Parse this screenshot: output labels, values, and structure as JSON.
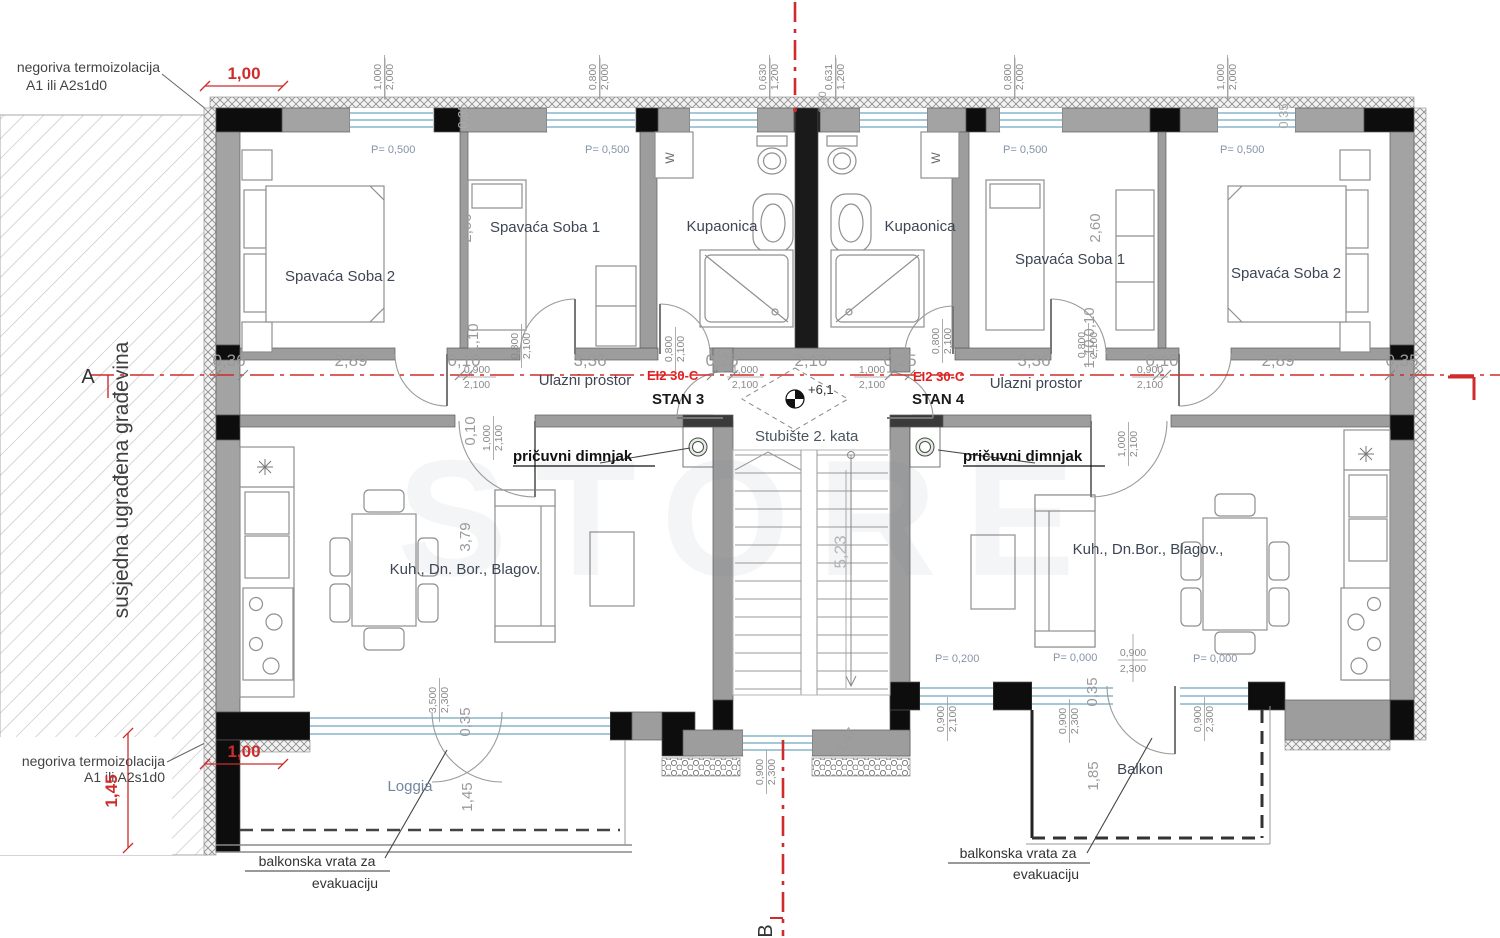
{
  "drawing": {
    "axes": {
      "a": "A",
      "b": "B"
    },
    "ann": {
      "thermo1": "negoriva termoizolacija",
      "thermo2": "A1 ili A2s1d0",
      "neighbor": "susjedna ugrađena građevina",
      "chimney": "pričuvni dimnjak",
      "fire": "EI2 30-C",
      "balk1": "balkonska vrata za",
      "balk2": "evakuaciju",
      "stair": "Stubište 2. kata",
      "elev": "+6,1",
      "washer": "W",
      "watermark": "STORE"
    },
    "apt": {
      "left": "STAN 3",
      "right": "STAN 4"
    },
    "rooms": {
      "bedroom2": "Spavaća Soba 2",
      "bedroom1": "Spavaća Soba 1",
      "bath": "Kupaonica",
      "entry": "Ulazni prostor",
      "living_l": "Kuh., Dn. Bor., Blagov.",
      "living_r": "Kuh., Dn.Bor., Blagov.,",
      "loggia": "Loggia",
      "balcony": "Balkon"
    },
    "dims": {
      "chain": [
        "0,36",
        "2,89",
        "0,10",
        "3,36",
        "0,25",
        "2,10",
        "0,25",
        "3,36",
        "0,10",
        "2,89",
        "0,35"
      ],
      "red_top": "1,00",
      "red_bottom": "1,00",
      "red_v": "1,45",
      "v260": "2,60",
      "v110": "1,10",
      "v010": "0,10",
      "v379": "3,79",
      "v035": "0,35",
      "v145": "1,45",
      "v523": "5,23",
      "v147": "1,47",
      "v185": "1,85",
      "v040": "0,40",
      "p500": "P= 0,500",
      "p200": "P= 0,200",
      "p000": "P= 0,000"
    },
    "open": {
      "w1000_2000": [
        "1,000",
        "2,000"
      ],
      "w0800_2000": [
        "0,800",
        "2,000"
      ],
      "w0630_1200": [
        "0,630",
        "1,200"
      ],
      "w0631_1200": [
        "0,631",
        "1,200"
      ],
      "d0900_2100": [
        "0,900",
        "2,100"
      ],
      "d1000_2100": [
        "1,000",
        "2,100"
      ],
      "d0800_2100": [
        "0,800",
        "2,100"
      ],
      "w3500_2300": [
        "3,500",
        "2,300"
      ],
      "w0900_2300": [
        "0,900",
        "2,300"
      ]
    }
  }
}
